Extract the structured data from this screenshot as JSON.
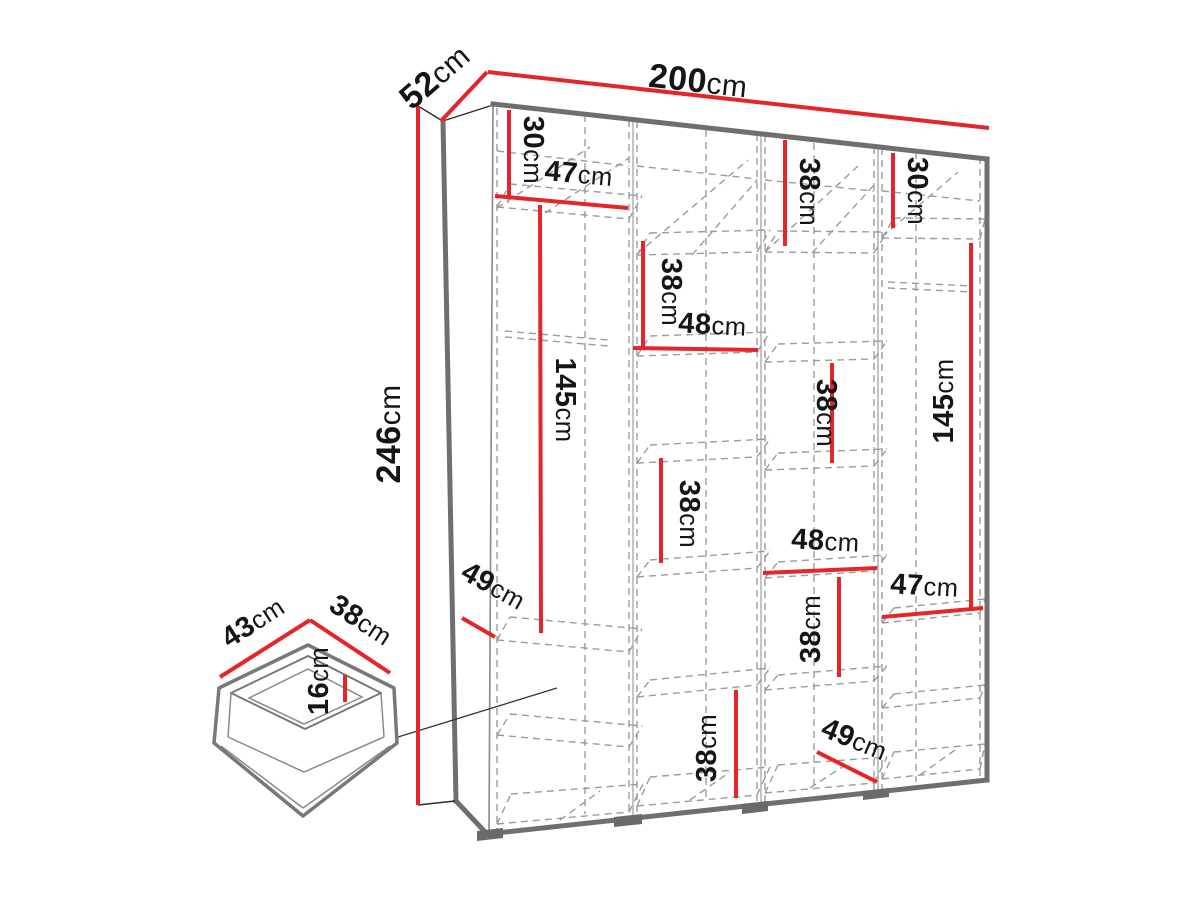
{
  "title": "Wardrobe dimension diagram",
  "colors": {
    "dimension_red": "#e52528",
    "carcass_gray": "#6f6f6f",
    "dashed_gray": "#9b9b9b",
    "text_black": "#151515",
    "background": "#ffffff"
  },
  "overall_dimensions": {
    "width": "200cm",
    "depth": "52cm",
    "height": "246cm"
  },
  "drawer_dimensions": {
    "width": "43cm",
    "depth": "38cm",
    "height": "16cm"
  },
  "labels": [
    {
      "id": "overall-width",
      "value": "200",
      "unit": "cm"
    },
    {
      "id": "overall-depth",
      "value": "52",
      "unit": "cm"
    },
    {
      "id": "overall-height",
      "value": "246",
      "unit": "cm"
    },
    {
      "id": "col1-top-section",
      "value": "30",
      "unit": "cm"
    },
    {
      "id": "col1-width",
      "value": "47",
      "unit": "cm"
    },
    {
      "id": "col1-hanging-height",
      "value": "145",
      "unit": "cm"
    },
    {
      "id": "col1-inner-depth",
      "value": "49",
      "unit": "cm"
    },
    {
      "id": "col2-top-gap",
      "value": "38",
      "unit": "cm"
    },
    {
      "id": "col2-width",
      "value": "48",
      "unit": "cm"
    },
    {
      "id": "col3-top-gap",
      "value": "38",
      "unit": "cm"
    },
    {
      "id": "col4-top-section",
      "value": "30",
      "unit": "cm"
    },
    {
      "id": "col4-hanging-height",
      "value": "145",
      "unit": "cm"
    },
    {
      "id": "col3-shelf-gap-upper",
      "value": "38",
      "unit": "cm"
    },
    {
      "id": "col2-shelf-gap-middle",
      "value": "38",
      "unit": "cm"
    },
    {
      "id": "col3-width",
      "value": "48",
      "unit": "cm"
    },
    {
      "id": "col3-shelf-gap-lower",
      "value": "38",
      "unit": "cm"
    },
    {
      "id": "col4-width",
      "value": "47",
      "unit": "cm"
    },
    {
      "id": "col2-shelf-gap-bottom",
      "value": "38",
      "unit": "cm"
    },
    {
      "id": "col3-inner-depth",
      "value": "49",
      "unit": "cm"
    },
    {
      "id": "drawer-width",
      "value": "43",
      "unit": "cm"
    },
    {
      "id": "drawer-depth",
      "value": "38",
      "unit": "cm"
    },
    {
      "id": "drawer-height",
      "value": "16",
      "unit": "cm"
    }
  ]
}
